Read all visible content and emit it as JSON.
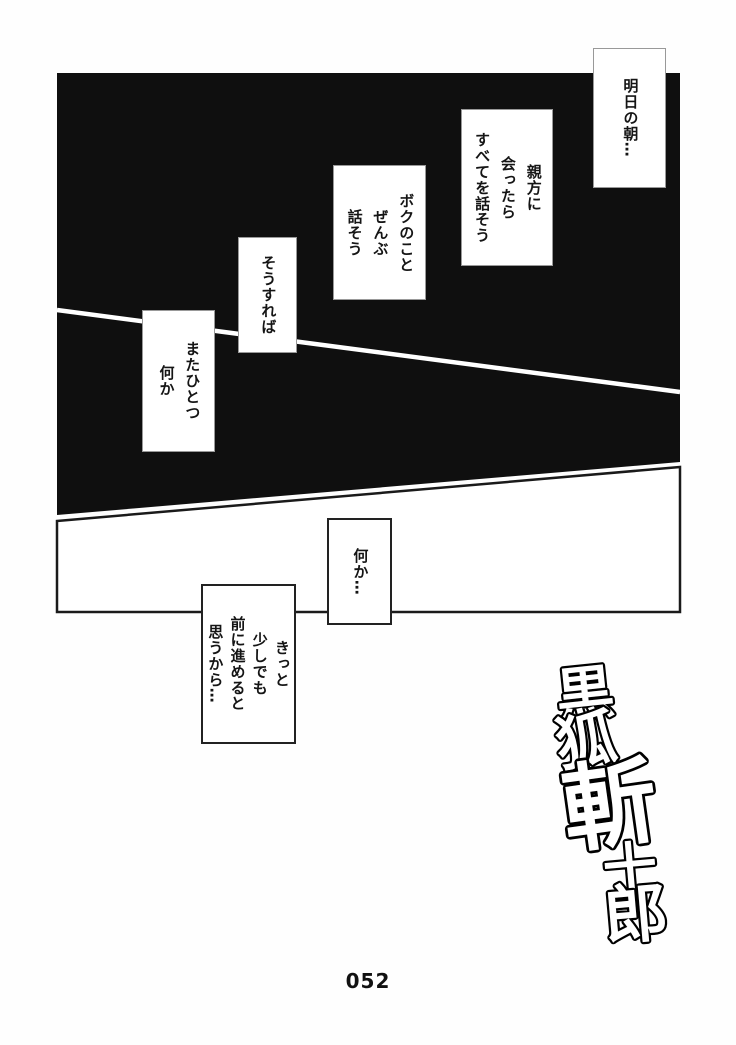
{
  "bubbles": [
    {
      "text": "明日の朝…"
    },
    {
      "text": "親方に\n会ったら\nすべてを話そう"
    },
    {
      "text": "ボクのこと\nぜんぶ\n話そう"
    },
    {
      "text": "そうすれば"
    },
    {
      "text": "またひとつ\n何か"
    },
    {
      "text": "何か…"
    },
    {
      "text": "きっと\n少しでも\n前に進めると\n思うから…"
    }
  ],
  "logo": {
    "title": "黒狐斬十郎",
    "chars": [
      "黒",
      "狐",
      "斬",
      "十",
      "郎"
    ]
  },
  "footer": {
    "page_number": "052"
  },
  "colors": {
    "panel_black": "#0f0f0f",
    "paper_white": "#fefefe",
    "divider_line_white": "#ffffff",
    "bubble_border_gray": "#999999",
    "bubble_border_dark": "#222222",
    "ink_black": "#111111"
  }
}
